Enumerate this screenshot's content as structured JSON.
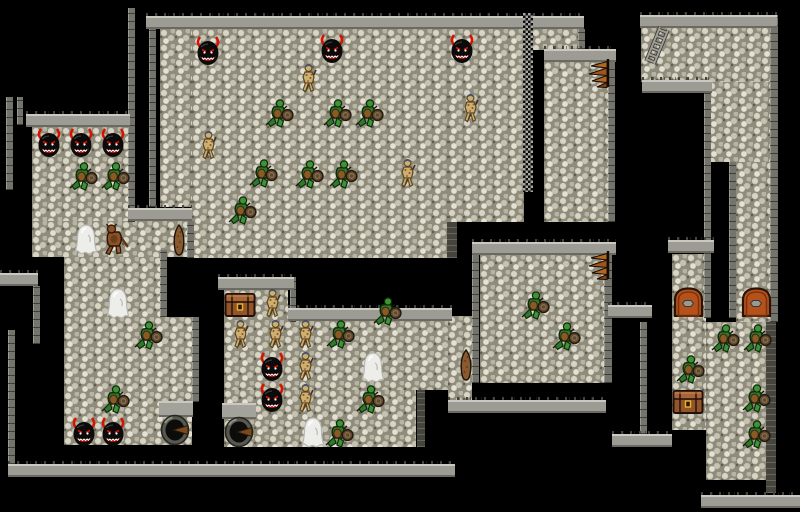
{
  "scene": {
    "name": "dungeon-level-map",
    "width": 800,
    "height": 512,
    "background": "#000000"
  },
  "palette": {
    "floor_base": "#8f8c7c",
    "floor_pebble": "#d8d5c6",
    "floor_pebble_light": "#e4e1d4",
    "wall_cap": "#9c9c94",
    "wall_cap_light": "#c9c9c1",
    "wall_side": "#74746c",
    "wall_side_dark": "#45453e",
    "fence_dark": "#0d0d0d",
    "fence_light": "#a8a8a0",
    "demon_black": "#0b0b0b",
    "demon_red": "#d41400",
    "orc_green": "#2f7a2a",
    "orc_green_light": "#3d9434",
    "orc_outline": "#0e2a0c",
    "orc_belly": "#8a5a24",
    "shield_brown": "#5f4a30",
    "gnoll_tan": "#cdb071",
    "gnoll_outline": "#5a4420",
    "ghost_white": "#ededea",
    "ghost_shade": "#b8b8b4",
    "beast_brown": "#8a5226",
    "wood_brown": "#8a5a2e",
    "wood_outline": "#1a120a",
    "chest_brown": "#93542a",
    "chest_lid": "#a8653a",
    "chest_gold": "#e8b81f",
    "door_orange": "#b5521c",
    "door_outline": "#2a1205",
    "stair_orange": "#b5651d",
    "ladder_gray": "#9f9f97",
    "well_rim": "#585850",
    "well_hole": "#0c0c0a"
  },
  "map": {
    "floors": [
      {
        "x": 160,
        "y": 29,
        "w": 32,
        "h": 178
      },
      {
        "x": 192,
        "y": 29,
        "w": 256,
        "h": 229
      },
      {
        "x": 448,
        "y": 29,
        "w": 76,
        "h": 193
      },
      {
        "x": 532,
        "y": 29,
        "w": 48,
        "h": 21
      },
      {
        "x": 544,
        "y": 62,
        "w": 64,
        "h": 160
      },
      {
        "x": 32,
        "y": 127,
        "w": 96,
        "h": 94
      },
      {
        "x": 32,
        "y": 221,
        "w": 160,
        "h": 36
      },
      {
        "x": 64,
        "y": 257,
        "w": 96,
        "h": 60
      },
      {
        "x": 64,
        "y": 317,
        "w": 128,
        "h": 128
      },
      {
        "x": 224,
        "y": 290,
        "w": 64,
        "h": 32
      },
      {
        "x": 224,
        "y": 321,
        "w": 224,
        "h": 69
      },
      {
        "x": 224,
        "y": 390,
        "w": 192,
        "h": 57
      },
      {
        "x": 448,
        "y": 316,
        "w": 24,
        "h": 86
      },
      {
        "x": 480,
        "y": 255,
        "w": 128,
        "h": 128
      },
      {
        "x": 641,
        "y": 27,
        "w": 130,
        "h": 55
      },
      {
        "x": 708,
        "y": 82,
        "w": 62,
        "h": 80
      },
      {
        "x": 736,
        "y": 162,
        "w": 34,
        "h": 160
      },
      {
        "x": 672,
        "y": 254,
        "w": 34,
        "h": 68
      },
      {
        "x": 672,
        "y": 322,
        "w": 34,
        "h": 108
      },
      {
        "x": 706,
        "y": 322,
        "w": 62,
        "h": 158
      }
    ],
    "wall_tops": [
      {
        "x": 146,
        "y": 16,
        "w": 438
      },
      {
        "x": 640,
        "y": 15,
        "w": 137
      },
      {
        "x": 642,
        "y": 80,
        "w": 70
      },
      {
        "x": 26,
        "y": 114,
        "w": 104
      },
      {
        "x": 128,
        "y": 208,
        "w": 64
      },
      {
        "x": 218,
        "y": 277,
        "w": 76
      },
      {
        "x": 288,
        "y": 308,
        "w": 164
      },
      {
        "x": 0,
        "y": 273,
        "w": 38
      },
      {
        "x": 472,
        "y": 242,
        "w": 144
      },
      {
        "x": 668,
        "y": 240,
        "w": 46
      },
      {
        "x": 544,
        "y": 49,
        "w": 72
      },
      {
        "x": 448,
        "y": 400,
        "w": 158
      },
      {
        "x": 8,
        "y": 464,
        "w": 447
      },
      {
        "x": 701,
        "y": 495,
        "w": 99
      },
      {
        "x": 608,
        "y": 305,
        "w": 44
      },
      {
        "x": 612,
        "y": 434,
        "w": 60
      },
      {
        "x": 159,
        "y": 401,
        "w": 34,
        "flat": true
      },
      {
        "x": 222,
        "y": 403,
        "w": 34,
        "flat": true
      }
    ],
    "wall_sides": [
      {
        "x": 149,
        "y": 29,
        "w": 7,
        "h": 178
      },
      {
        "x": 128,
        "y": 8,
        "w": 7,
        "h": 214
      },
      {
        "x": 6,
        "y": 97,
        "w": 7,
        "h": 93
      },
      {
        "x": 17,
        "y": 97,
        "w": 6,
        "h": 28
      },
      {
        "x": 33,
        "y": 286,
        "w": 7,
        "h": 58
      },
      {
        "x": 8,
        "y": 330,
        "w": 7,
        "h": 134
      },
      {
        "x": 160,
        "y": 250,
        "w": 7,
        "h": 67
      },
      {
        "x": 187,
        "y": 221,
        "w": 7,
        "h": 37
      },
      {
        "x": 192,
        "y": 317,
        "w": 7,
        "h": 85
      },
      {
        "x": 472,
        "y": 255,
        "w": 7,
        "h": 128
      },
      {
        "x": 604,
        "y": 255,
        "w": 8,
        "h": 128
      },
      {
        "x": 447,
        "y": 222,
        "w": 10,
        "h": 36,
        "dark": true
      },
      {
        "x": 417,
        "y": 390,
        "w": 8,
        "h": 57,
        "dark": true
      },
      {
        "x": 290,
        "y": 277,
        "w": 6,
        "h": 45
      },
      {
        "x": 608,
        "y": 49,
        "w": 7,
        "h": 173
      },
      {
        "x": 578,
        "y": 29,
        "w": 7,
        "h": 20
      },
      {
        "x": 704,
        "y": 82,
        "w": 7,
        "h": 236
      },
      {
        "x": 729,
        "y": 162,
        "w": 7,
        "h": 156
      },
      {
        "x": 770,
        "y": 15,
        "w": 8,
        "h": 307
      },
      {
        "x": 766,
        "y": 322,
        "w": 10,
        "h": 171,
        "dark": true
      },
      {
        "x": 640,
        "y": 322,
        "w": 7,
        "h": 112
      }
    ],
    "fence": {
      "x": 523,
      "y": 13,
      "w": 10,
      "h": 179
    }
  },
  "sprites": [
    {
      "type": "demon-head",
      "x": 194,
      "y": 36
    },
    {
      "type": "demon-head",
      "x": 318,
      "y": 34
    },
    {
      "type": "demon-head",
      "x": 448,
      "y": 34
    },
    {
      "type": "demon-head",
      "x": 35,
      "y": 128
    },
    {
      "type": "demon-head",
      "x": 67,
      "y": 128
    },
    {
      "type": "demon-head",
      "x": 99,
      "y": 128
    },
    {
      "type": "demon-head",
      "x": 258,
      "y": 352
    },
    {
      "type": "demon-head",
      "x": 258,
      "y": 383
    },
    {
      "type": "demon-head",
      "x": 70,
      "y": 417
    },
    {
      "type": "demon-head",
      "x": 99,
      "y": 417
    },
    {
      "type": "orc-warrior",
      "x": 262,
      "y": 97
    },
    {
      "type": "orc-warrior",
      "x": 320,
      "y": 97
    },
    {
      "type": "orc-warrior",
      "x": 352,
      "y": 97
    },
    {
      "type": "orc-warrior",
      "x": 246,
      "y": 157
    },
    {
      "type": "orc-warrior",
      "x": 292,
      "y": 158
    },
    {
      "type": "orc-warrior",
      "x": 326,
      "y": 158
    },
    {
      "type": "orc-warrior",
      "x": 225,
      "y": 194
    },
    {
      "type": "orc-warrior",
      "x": 66,
      "y": 160
    },
    {
      "type": "orc-warrior",
      "x": 98,
      "y": 160
    },
    {
      "type": "orc-warrior",
      "x": 131,
      "y": 319
    },
    {
      "type": "orc-warrior",
      "x": 98,
      "y": 383
    },
    {
      "type": "orc-warrior",
      "x": 323,
      "y": 318
    },
    {
      "type": "orc-warrior",
      "x": 370,
      "y": 295
    },
    {
      "type": "orc-warrior",
      "x": 353,
      "y": 383
    },
    {
      "type": "orc-warrior",
      "x": 322,
      "y": 417
    },
    {
      "type": "orc-warrior",
      "x": 518,
      "y": 289
    },
    {
      "type": "orc-warrior",
      "x": 549,
      "y": 320
    },
    {
      "type": "orc-warrior",
      "x": 708,
      "y": 322
    },
    {
      "type": "orc-warrior",
      "x": 740,
      "y": 322
    },
    {
      "type": "orc-warrior",
      "x": 673,
      "y": 353
    },
    {
      "type": "orc-warrior",
      "x": 739,
      "y": 382
    },
    {
      "type": "orc-warrior",
      "x": 739,
      "y": 418
    },
    {
      "type": "gnoll",
      "x": 296,
      "y": 63
    },
    {
      "type": "gnoll",
      "x": 458,
      "y": 93
    },
    {
      "type": "gnoll",
      "x": 395,
      "y": 158
    },
    {
      "type": "gnoll",
      "x": 196,
      "y": 130
    },
    {
      "type": "gnoll",
      "x": 260,
      "y": 288
    },
    {
      "type": "gnoll",
      "x": 228,
      "y": 319
    },
    {
      "type": "gnoll",
      "x": 263,
      "y": 319
    },
    {
      "type": "gnoll",
      "x": 293,
      "y": 319
    },
    {
      "type": "gnoll",
      "x": 293,
      "y": 351
    },
    {
      "type": "gnoll",
      "x": 293,
      "y": 383
    },
    {
      "type": "ghost",
      "x": 73,
      "y": 223
    },
    {
      "type": "ghost",
      "x": 105,
      "y": 287
    },
    {
      "type": "ghost",
      "x": 360,
      "y": 351
    },
    {
      "type": "ghost",
      "x": 300,
      "y": 416
    },
    {
      "type": "beast",
      "x": 100,
      "y": 222
    },
    {
      "type": "wooden-club",
      "x": 171,
      "y": 224
    },
    {
      "type": "wooden-club",
      "x": 458,
      "y": 349
    },
    {
      "type": "treasure-chest",
      "x": 224,
      "y": 290
    },
    {
      "type": "treasure-chest",
      "x": 672,
      "y": 387
    },
    {
      "type": "door",
      "x": 673,
      "y": 287
    },
    {
      "type": "door",
      "x": 741,
      "y": 287
    },
    {
      "type": "spiral-staircase",
      "x": 585,
      "y": 58
    },
    {
      "type": "spiral-staircase",
      "x": 585,
      "y": 250
    },
    {
      "type": "ladder",
      "x": 643,
      "y": 26
    },
    {
      "type": "well",
      "x": 160,
      "y": 414
    },
    {
      "type": "well",
      "x": 224,
      "y": 416
    }
  ]
}
